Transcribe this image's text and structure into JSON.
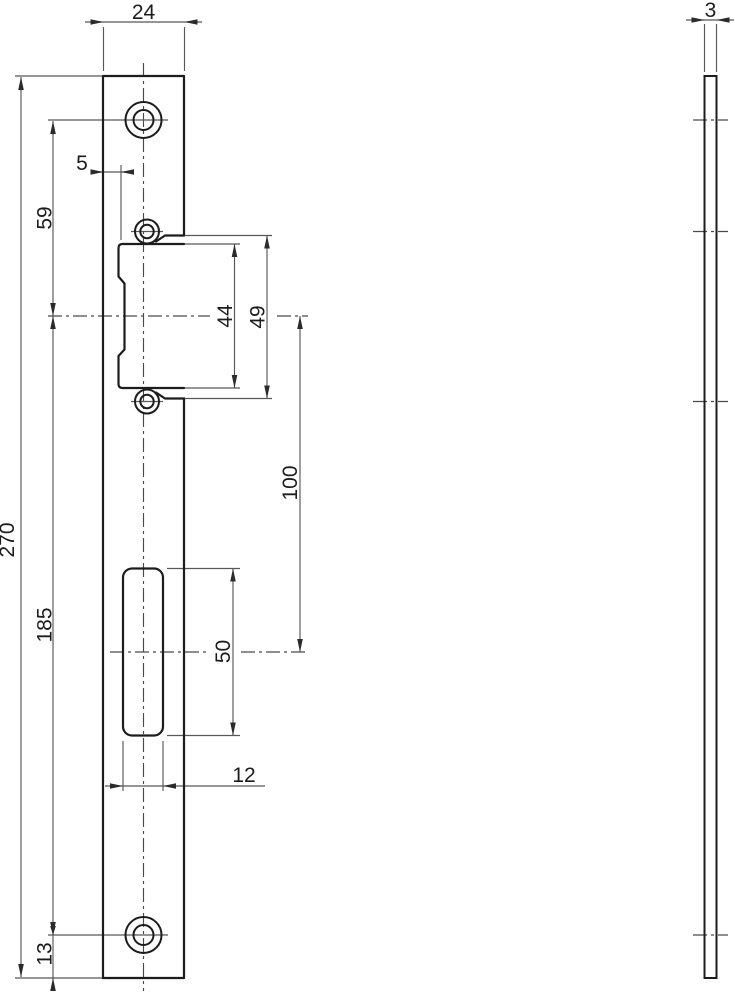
{
  "drawing": {
    "type": "technical-drawing",
    "part": "strike-plate",
    "colors": {
      "line": "#1c1c1c",
      "dim_line": "#585858",
      "background": "#ffffff"
    },
    "dimensions": {
      "plate_width": "24",
      "thickness": "3",
      "lip_offset": "5",
      "top_hole_to_latch_center": "59",
      "latch_window_height": "44",
      "latch_cutout_height": "49",
      "latch_to_deadbolt_center": "100",
      "latch_center_to_bottom_hole": "185",
      "deadbolt_slot_height": "50",
      "slot_width": "12",
      "bottom_hole_edge_margin": "13",
      "total_length": "270"
    }
  }
}
